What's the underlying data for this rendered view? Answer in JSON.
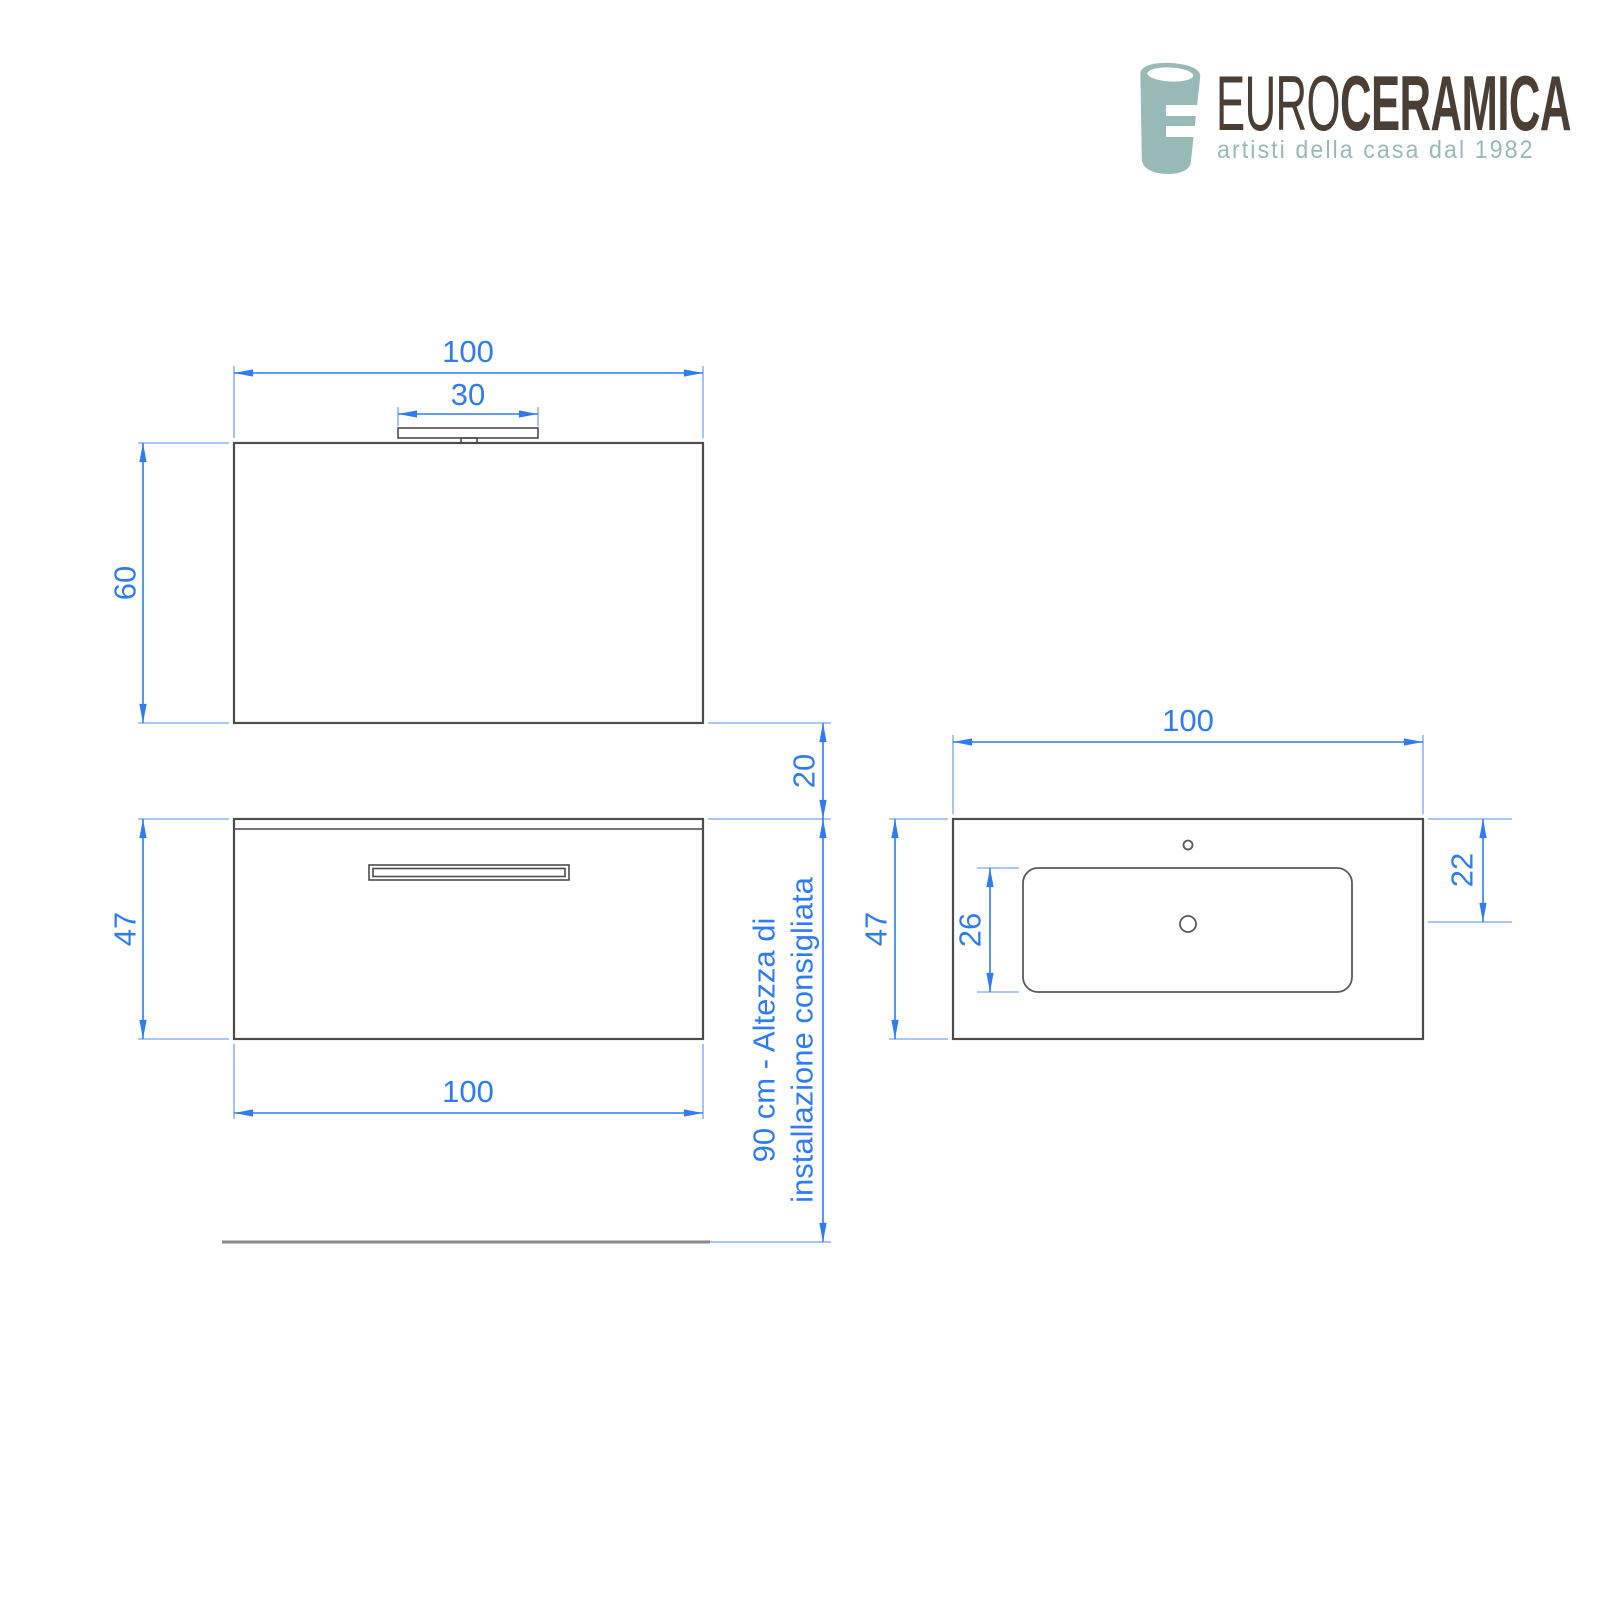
{
  "logo": {
    "brand_prefix": "EURO",
    "brand_suffix": "CERAMICA",
    "tagline": "artisti della casa dal 1982",
    "teal": "#97bab6",
    "brown": "#4a3e35"
  },
  "colors": {
    "dimension_blue": "#2e7cf2",
    "extension_blue": "#8fb4f7",
    "outline_gray": "#4c4c4c"
  },
  "drawing": {
    "mirror_front": {
      "width_label": "100",
      "light_width_label": "30",
      "height_label": "60"
    },
    "spacing": {
      "mirror_cabinet_gap_label": "20"
    },
    "cabinet_front": {
      "height_label": "47",
      "width_label": "100"
    },
    "install_height": {
      "line1": "90 cm - Altezza di",
      "line2": "installazione consigliata"
    },
    "basin_top": {
      "width_label": "100",
      "depth_label": "47",
      "bowl_depth_label": "26",
      "drain_offset_label": "22"
    }
  }
}
